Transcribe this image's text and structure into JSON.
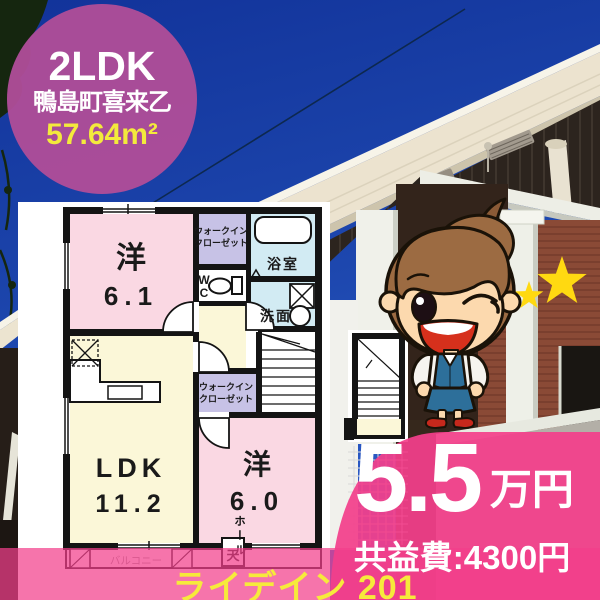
{
  "badge": {
    "layout_type": "2LDK",
    "location": "鴨島町喜来乙",
    "floor_area": "57.64m²"
  },
  "price": {
    "rent_amount": "5.5",
    "rent_unit": "万円",
    "common_fee": "共益費:4300円"
  },
  "footer": {
    "property_name": "ライデイン 201"
  },
  "floorplan": {
    "rooms": {
      "western1_label": "洋",
      "western1_size": "6.1",
      "wic1_line1": "ウォークイン",
      "wic1_line2": "クローゼット",
      "bath": "浴室",
      "wc_line1": "W",
      "wc_line2": "C",
      "washroom": "洗面",
      "hall": "ホール",
      "wic2_line1": "ウォークイン",
      "wic2_line2": "クローゼット",
      "ldk_label": "LDK",
      "ldk_size": "11.2",
      "western2_label": "洋",
      "western2_size": "6.0",
      "balcony": "バルコニー",
      "ceiling_mark": "天"
    }
  },
  "colors": {
    "badge_bg": "#af4d98",
    "price_overlay": "#f33f8b",
    "highlight_yellow": "#f3ea3c",
    "room_pink": "#fad8e3",
    "room_yellow": "#fbf7d8",
    "room_purple": "#c7c2e6",
    "room_blue": "#d2ebf3",
    "star_yellow": "#ffd911",
    "sky_blue": "#1d47ae"
  }
}
